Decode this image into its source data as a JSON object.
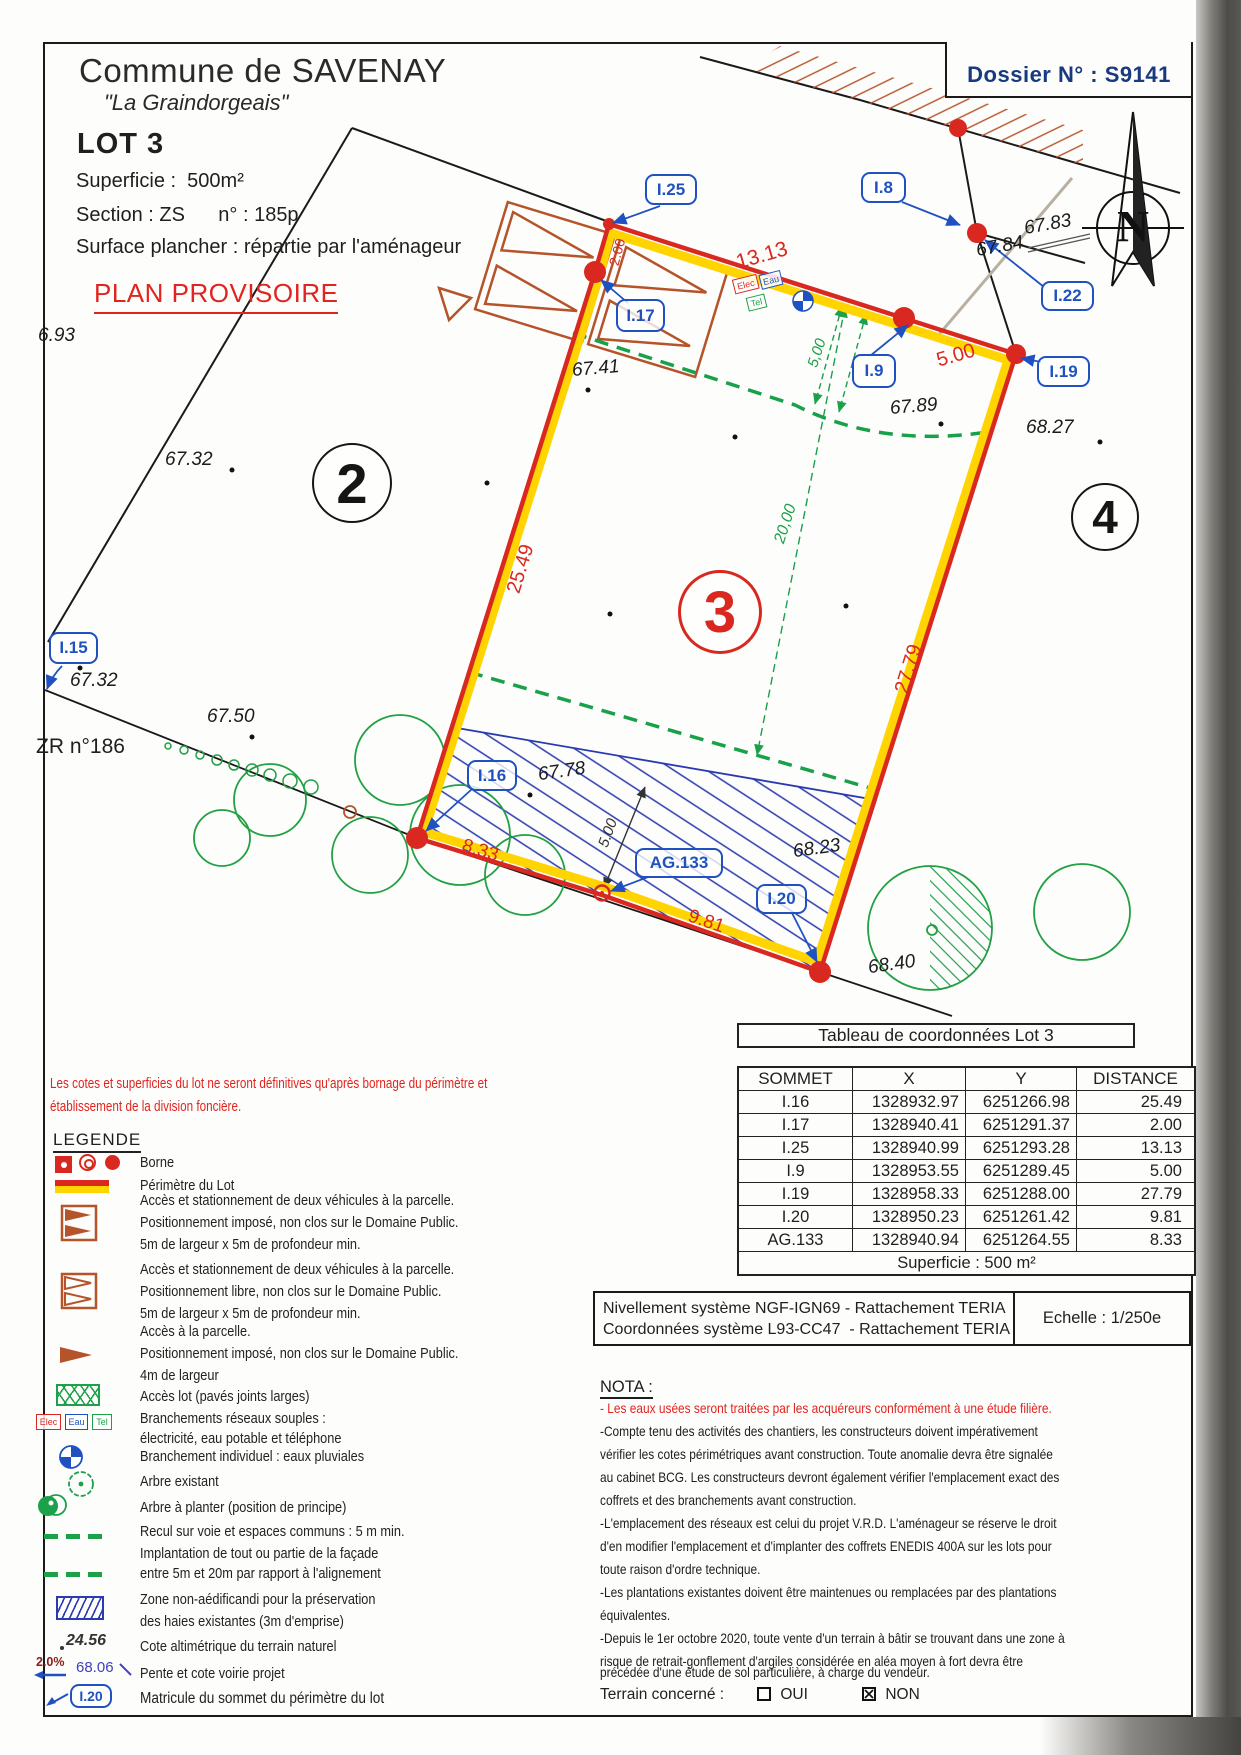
{
  "colors": {
    "lot_red": "#d92820",
    "lot_yellow": "#ffd400",
    "label_blue": "#1f52c0",
    "dossier_navy": "#173a80",
    "green": "#1da04a",
    "orange": "#b5532a",
    "hatch_blue": "#2a3ab0",
    "text_red": "#e02420"
  },
  "header": {
    "commune": "Commune de SAVENAY",
    "place": "\"La Graindorgeais\"",
    "lot": "LOT 3",
    "superficie": "Superficie :  500m²",
    "section": "Section : ZS      n° : 185p",
    "surface_plancher": "Surface plancher : répartie par l'aménageur",
    "plan_status": "PLAN PROVISOIRE",
    "dossier": "Dossier N° : S9141"
  },
  "plan": {
    "north": "N",
    "parcel2": "2",
    "parcel3": "3",
    "parcel4": "4",
    "zr": "ZR n°186",
    "labels": {
      "i25": "I.25",
      "i17": "I.17",
      "i8": "I.8",
      "i9": "I.9",
      "i19": "I.19",
      "i22": "I.22",
      "i15": "I.15",
      "i16": "I.16",
      "i20": "I.20",
      "ag133": "AG.133"
    },
    "dims": {
      "d13_13": "13.13",
      "d2_00": "2.00",
      "d5_00_street": "5.00",
      "d25_49": "25.49",
      "d27_79": "27.79",
      "d9_81": "9.81",
      "d8_33": "8.33",
      "d20_00": "20,00",
      "d5_00_green": "5,00",
      "d5_00_hedge": "5.00"
    },
    "levels": {
      "l6_93": "6.93",
      "l67_41": "67.41",
      "l67_83": "67.83",
      "l67_84": "67.84",
      "l67_89": "67.89",
      "l67_32_a": "67.32",
      "l68_27": "68.27",
      "l67_32_b": "67.32",
      "l67_50": "67.50",
      "l67_78": "67.78",
      "l68_23": "68.23",
      "l68_40": "68.40"
    },
    "utilities": {
      "elec": "Elec",
      "eau": "Eau",
      "tel": "Tel"
    }
  },
  "disclaimer": {
    "line1": "Les cotes et superficies du lot ne seront définitives qu'après bornage du périmètre et",
    "line2": "établissement de la division foncière."
  },
  "legend": {
    "title": "LEGENDE",
    "borne": "Borne",
    "perimetre": "Périmètre du Lot",
    "acces_impose": [
      "Accès et stationnement de deux véhicules à la parcelle.",
      "Positionnement imposé, non clos sur le Domaine Public.",
      "5m de largeur x 5m de profondeur min."
    ],
    "acces_libre": [
      "Accès et stationnement de deux véhicules à la parcelle.",
      "Positionnement libre, non clos sur le Domaine Public.",
      "5m de largeur x 5m de profondeur min."
    ],
    "acces_parcelle": [
      "Accès à la parcelle.",
      "Positionnement imposé, non clos sur le Domaine Public.",
      "4m de largeur"
    ],
    "acces_lot": "Accès lot (pavés joints larges)",
    "branchements": [
      "Branchements réseaux souples :",
      "électricité, eau potable et téléphone"
    ],
    "branchement_ep": "Branchement individuel : eaux pluviales",
    "arbre_existant": "Arbre existant",
    "arbre_planter": "Arbre à planter (position de principe)",
    "recul": [
      "Recul sur voie et espaces communs : 5 m min.",
      "Implantation de tout ou partie de la façade",
      "entre 5m et 20m par rapport à l'alignement"
    ],
    "zone_non_aedificandi": [
      "Zone non-aédificandi pour la préservation",
      "des haies existantes (3m d'emprise)"
    ],
    "cote_value": "24.56",
    "cote_text": "Cote altimétrique du terrain naturel",
    "pente_pct": "2.0%",
    "pente_cote": "68.06",
    "pente_text": "Pente et cote voirie projet",
    "matricule_example": "I.20",
    "matricule_text": "Matricule du sommet du périmètre du lot"
  },
  "table": {
    "title": "Tableau de coordonnées Lot 3",
    "headers": [
      "SOMMET",
      "X",
      "Y",
      "DISTANCE"
    ],
    "rows": [
      [
        "I.16",
        "1328932.97",
        "6251266.98",
        "25.49"
      ],
      [
        "I.17",
        "1328940.41",
        "6251291.37",
        "2.00"
      ],
      [
        "I.25",
        "1328940.99",
        "6251293.28",
        "13.13"
      ],
      [
        "I.9",
        "1328953.55",
        "6251289.45",
        "5.00"
      ],
      [
        "I.19",
        "1328958.33",
        "6251288.00",
        "27.79"
      ],
      [
        "I.20",
        "1328950.23",
        "6251261.42",
        "9.81"
      ],
      [
        "AG.133",
        "1328940.94",
        "6251264.55",
        "8.33"
      ]
    ],
    "footer": "Superficie : 500 m²"
  },
  "reference": {
    "line1": "Nivellement système NGF-IGN69 - Rattachement TERIA",
    "line2": "Coordonnées système L93-CC47  - Rattachement TERIA",
    "echelle": "Echelle : 1/250e"
  },
  "nota": {
    "title": "NOTA :",
    "red_line": "- Les eaux usées seront traitées par les acquéreurs conformément à une étude filière.",
    "lines": [
      "-Compte tenu des activités des chantiers, les constructeurs doivent impérativement",
      "vérifier les cotes périmétriques avant construction. Toute anomalie devra être signalée",
      "au cabinet BCG. Les constructeurs devront également vérifier l'emplacement exact des",
      "coffrets et des branchements avant construction.",
      "-L'emplacement des réseaux est celui du projet V.R.D. L'aménageur se réserve le droit",
      "d'en modifier l'emplacement et d'implanter des coffrets ENEDIS 400A sur les lots pour",
      "toute raison d'ordre technique.",
      "-Les plantations existantes doivent être maintenues ou remplacées par des plantations",
      "équivalentes.",
      "-Depuis le 1er octobre 2020, toute vente d'un terrain à bâtir se trouvant dans une zone à",
      "risque de retrait-gonflement d'argiles considérée en aléa moyen à fort devra être",
      "précédée d'une étude de sol particulière, à charge du vendeur."
    ],
    "terrain": "Terrain concerné :",
    "oui": "OUI",
    "non": "NON"
  }
}
